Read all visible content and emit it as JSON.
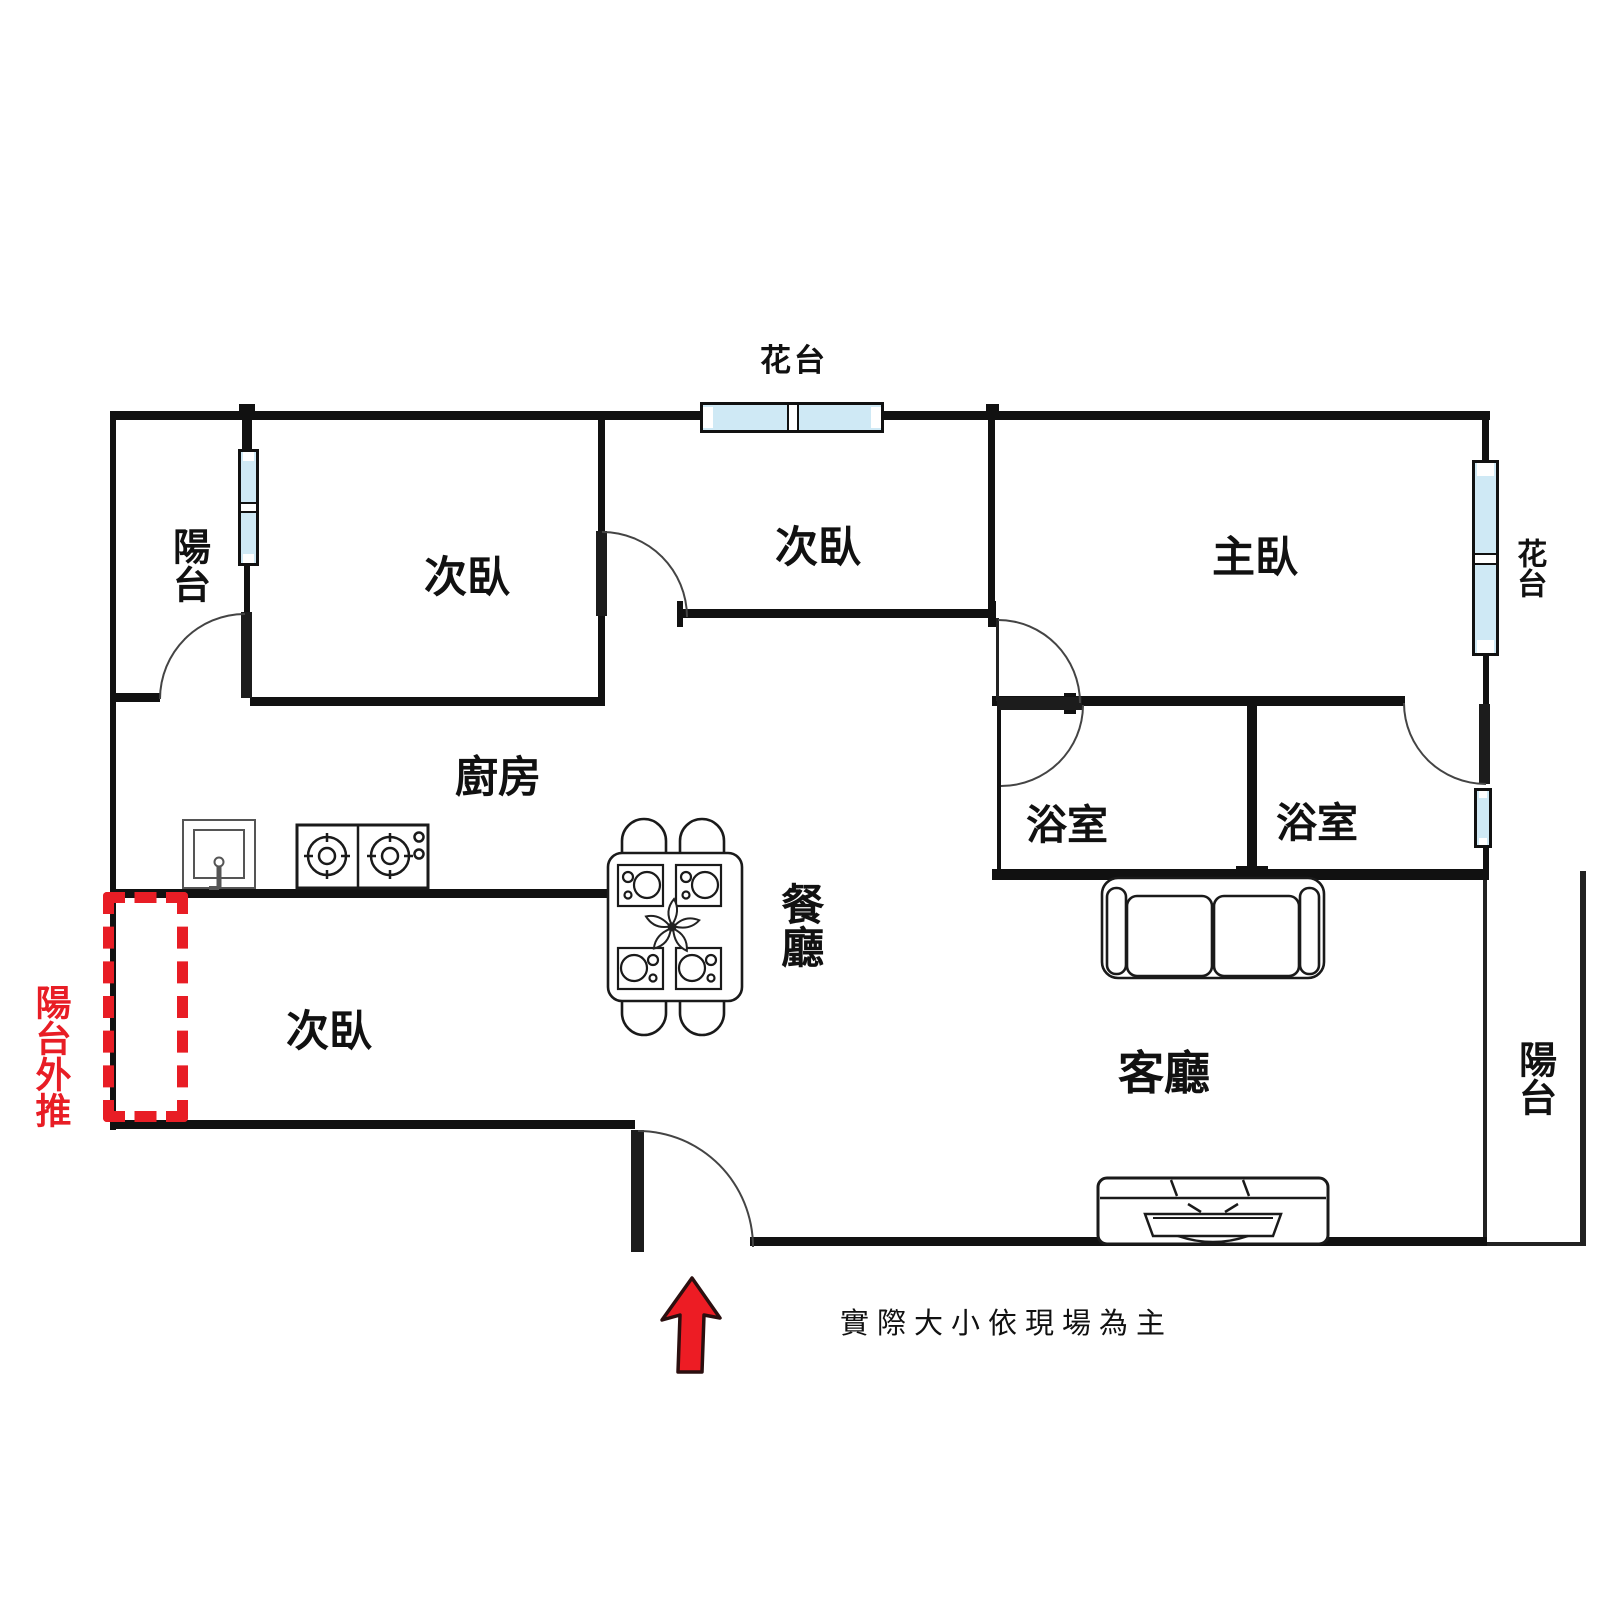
{
  "title": "apartment-floor-plan",
  "colors": {
    "wall": "#111111",
    "door_arc": "#444444",
    "window_fill": "#cfe9f5",
    "accent_red": "#e81d25",
    "text": "#111111"
  },
  "rooms": {
    "balcony_top_left": {
      "label": "陽台"
    },
    "bedroom_top_left": {
      "label": "次臥"
    },
    "bedroom_middle": {
      "label": "次臥"
    },
    "master_bedroom": {
      "label": "主臥"
    },
    "kitchen": {
      "label": "廚房"
    },
    "bedroom_bottom_left": {
      "label": "次臥"
    },
    "dining_room": {
      "label": "餐廳"
    },
    "living_room": {
      "label": "客廳"
    },
    "bathroom_left": {
      "label": "浴室"
    },
    "bathroom_right": {
      "label": "浴室"
    },
    "balcony_right": {
      "label": "陽台"
    }
  },
  "features": {
    "flower_bed_top": {
      "label": "花台"
    },
    "flower_bed_right": {
      "label": "花台"
    },
    "balcony_extension": {
      "label": "陽台外推",
      "color": "#e81d25"
    },
    "entrance_arrow": {
      "color": "#ed1c24"
    }
  },
  "annotations": {
    "disclaimer": "實際大小依現場為主"
  }
}
